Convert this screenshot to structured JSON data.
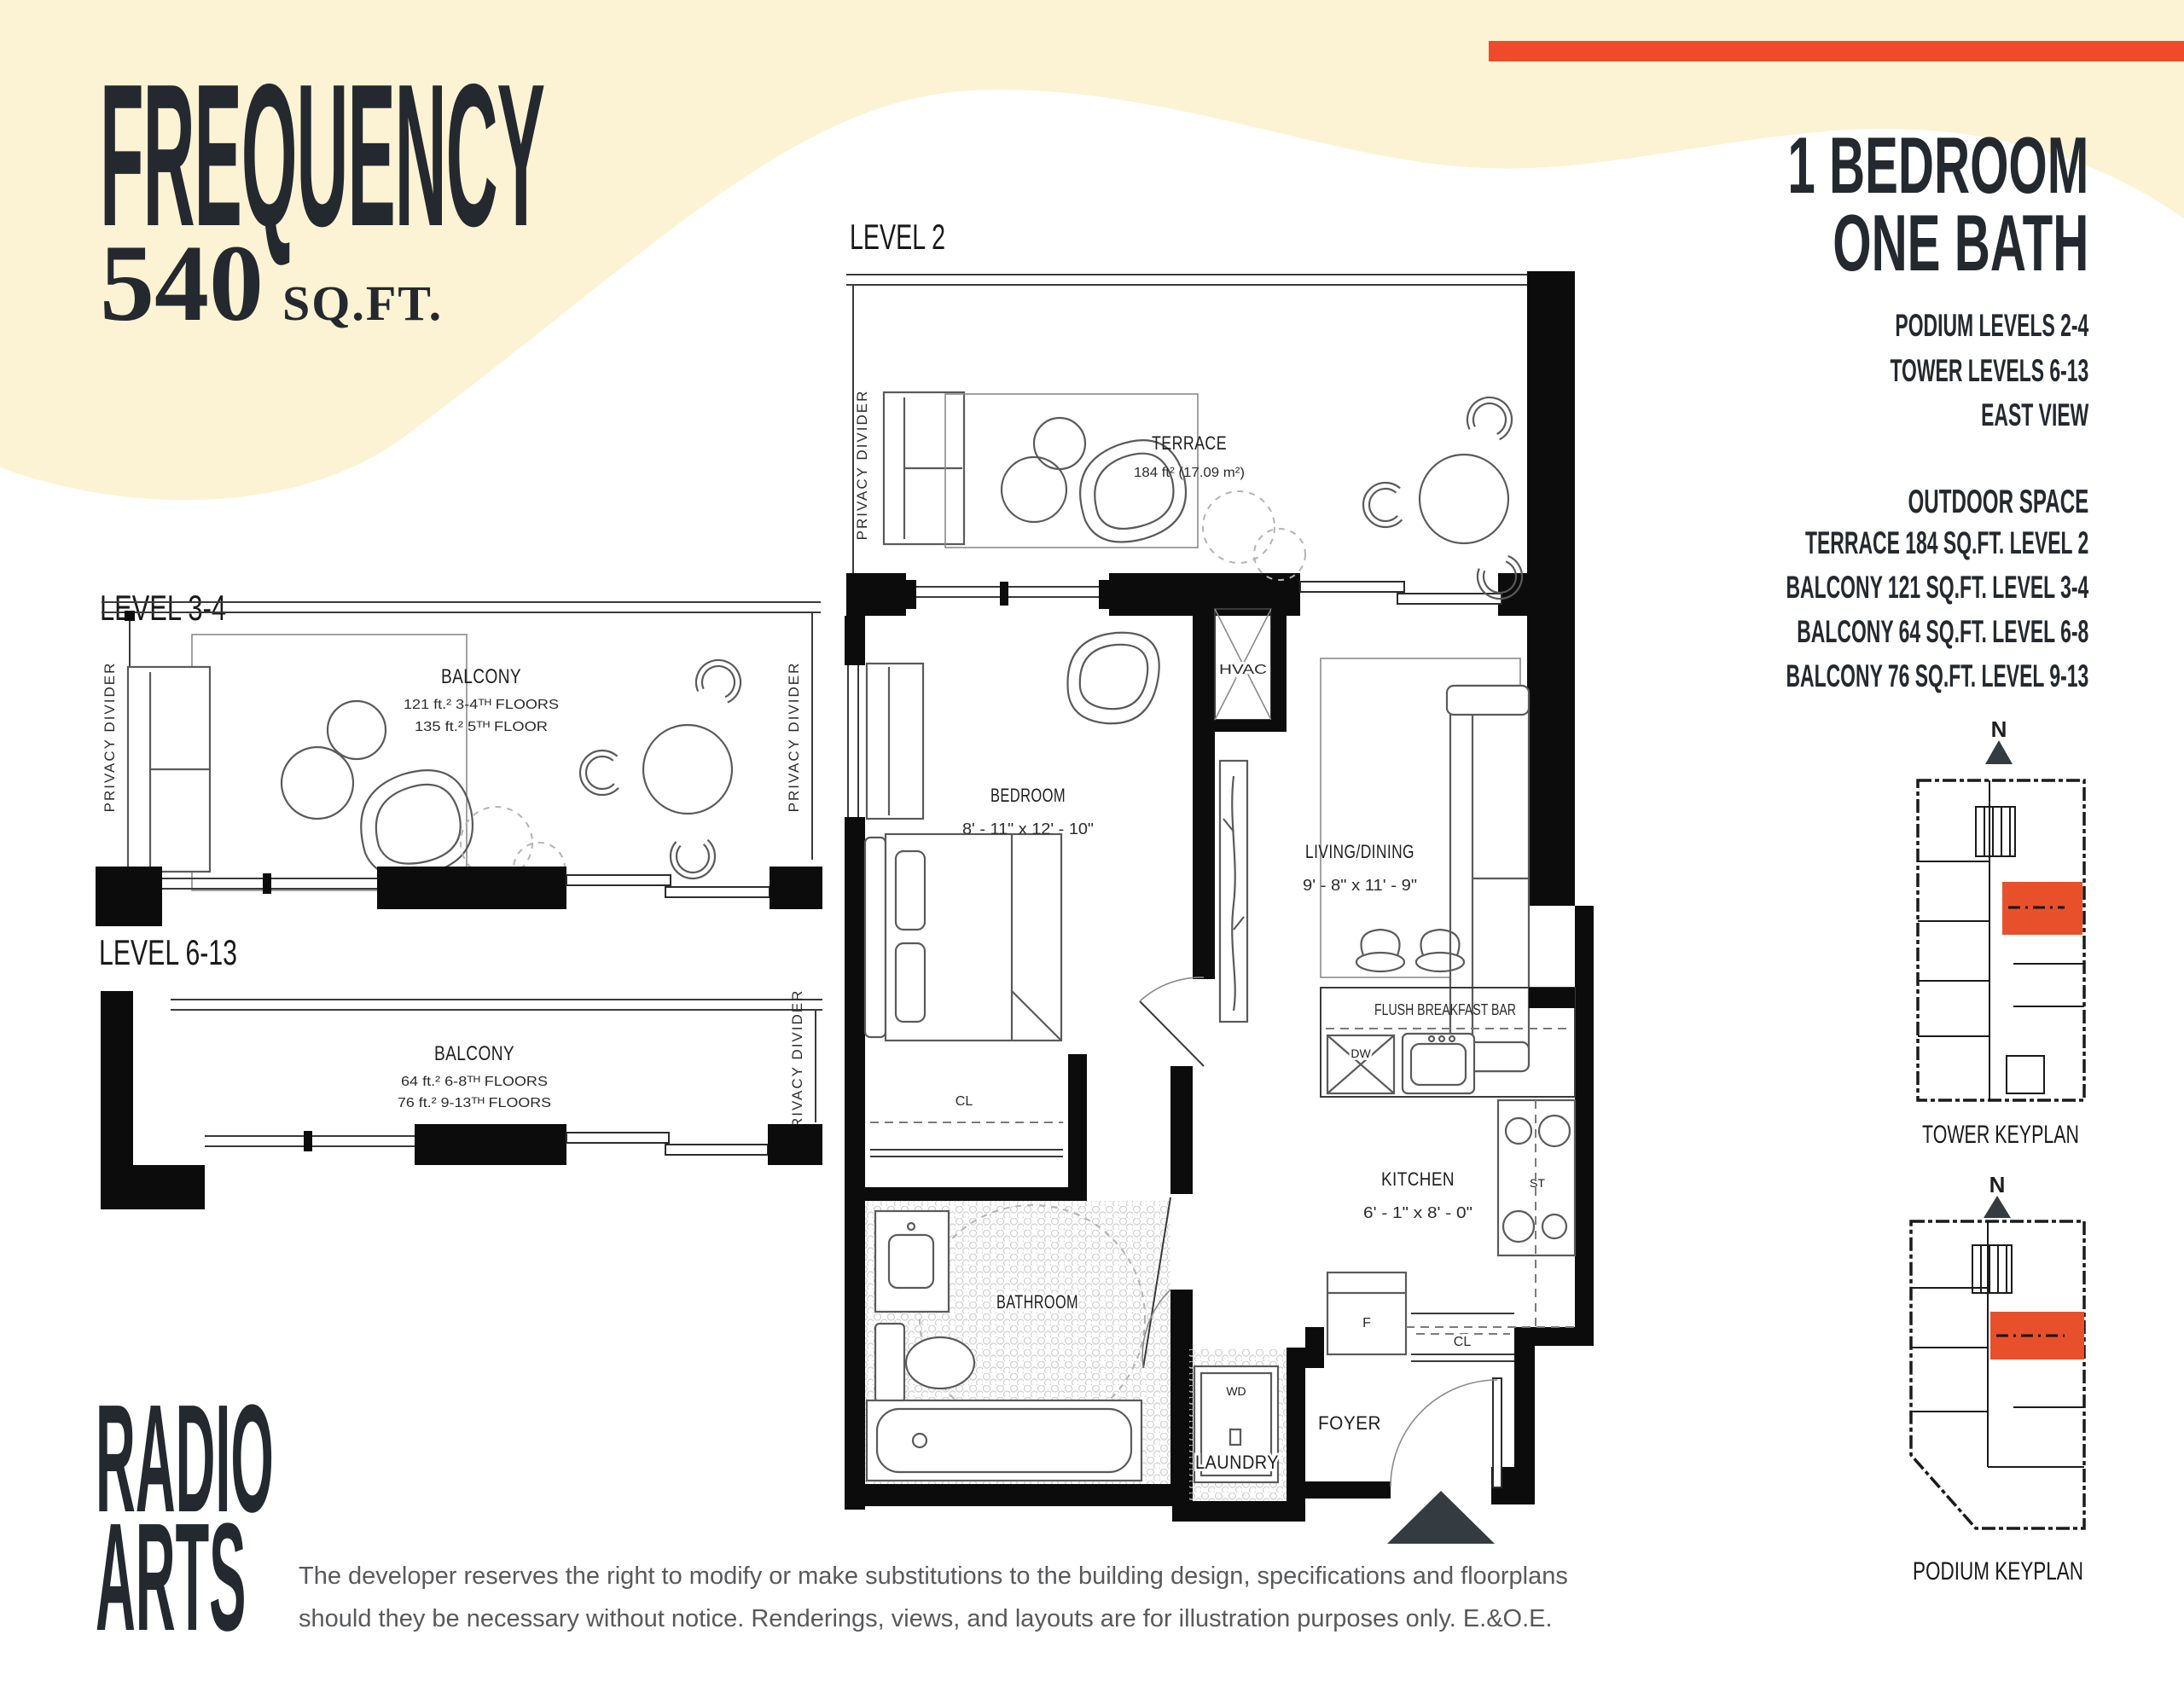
{
  "colors": {
    "cream": "#FCF3D4",
    "accent": "#EF4B2B",
    "ink": "#24292F",
    "keyplan_red": "#E8502C",
    "disclaimer_grey": "#58595b"
  },
  "title": {
    "name": "FREQUENCY",
    "area": "540",
    "area_unit": "SQ.FT."
  },
  "unit_info": {
    "type_line1": "1 BEDROOM",
    "type_line2": "ONE BATH",
    "levels": [
      "PODIUM LEVELS 2-4",
      "TOWER LEVELS 6-13",
      "EAST VIEW"
    ],
    "outdoor_title": "OUTDOOR SPACE",
    "outdoor": [
      "TERRACE 184 SQ.FT. LEVEL 2",
      "BALCONY 121 SQ.FT. LEVEL 3-4",
      "BALCONY 64 SQ.FT. LEVEL 6-8",
      "BALCONY 76 SQ.FT. LEVEL 9-13"
    ]
  },
  "plans": {
    "level2": {
      "label": "LEVEL 2",
      "terrace": "TERRACE",
      "terrace_area": "184 ft² (17.09 m²)",
      "privacy": "PRIVACY DIVIDER",
      "hvac": "HVAC",
      "bedroom": "BEDROOM",
      "bedroom_dims": "8' - 11\" x   12' - 10\"",
      "living": "LIVING/DINING",
      "living_dims": "9' - 8\" x   11' - 9\"",
      "breakfast": "FLUSH BREAKFAST BAR",
      "dw": "DW",
      "kitchen": "KITCHEN",
      "kitchen_dims": "6' - 1\" x   8' - 0\"",
      "st": "ST",
      "f": "F",
      "cl": "CL",
      "bathroom": "BATHROOM",
      "wd": "WD",
      "laundry": "LAUNDRY",
      "foyer": "FOYER"
    },
    "level3_4": {
      "label": "LEVEL 3-4",
      "balcony": "BALCONY",
      "area1": "121 ft.² 3-4ᵀᴴ FLOORS",
      "area2": "135 ft.² 5ᵀᴴ FLOOR",
      "privacy": "PRIVACY DIVIDER"
    },
    "level6_13": {
      "label": "LEVEL 6-13",
      "balcony": "BALCONY",
      "area1": "64 ft.² 6-8ᵀᴴ FLOORS",
      "area2": "76 ft.² 9-13ᵀᴴ FLOORS",
      "privacy": "PRIVACY DIVIDER"
    }
  },
  "keyplans": {
    "tower_label": "TOWER KEYPLAN",
    "podium_label": "PODIUM KEYPLAN",
    "north": "N"
  },
  "footer": {
    "logo_line1": "RADIO",
    "logo_line2": "ARTS",
    "disclaimer_line1": "The developer reserves the right to modify or make substitutions to the building design, specifications and floorplans",
    "disclaimer_line2": "should they be necessary without notice. Renderings, views, and layouts are for illustration purposes only. E.&O.E."
  }
}
